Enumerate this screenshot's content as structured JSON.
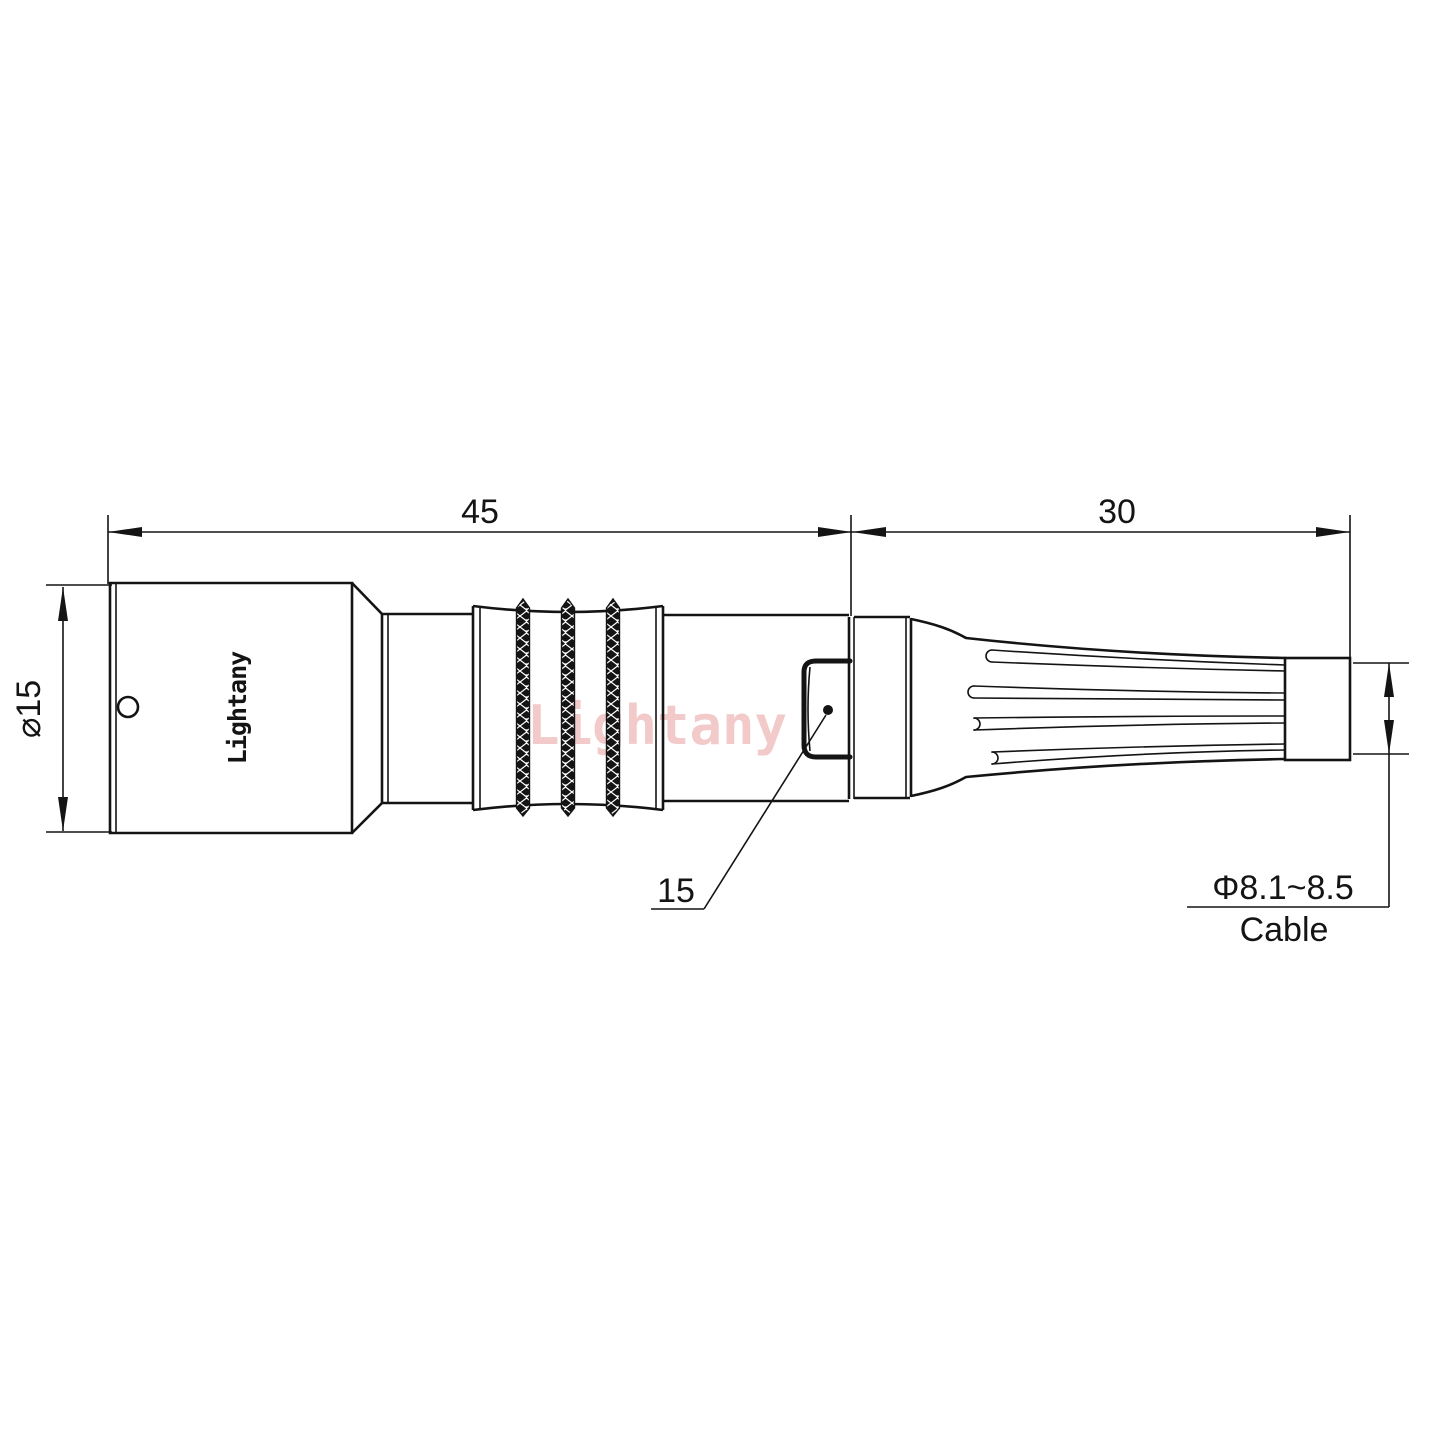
{
  "drawing": {
    "type": "technical-drawing",
    "background_color": "#ffffff",
    "line_color": "#141414",
    "watermark": {
      "text": "Lightany",
      "color": "#e89f9f"
    },
    "body": {
      "logo": "Lightany"
    },
    "dimensions": {
      "front_section_length": "45",
      "boot_section_length": "30",
      "body_diameter": "⌀15",
      "latch_ref": "15",
      "cable_diameter": "Φ8.1~8.5",
      "cable_label": "Cable"
    }
  }
}
